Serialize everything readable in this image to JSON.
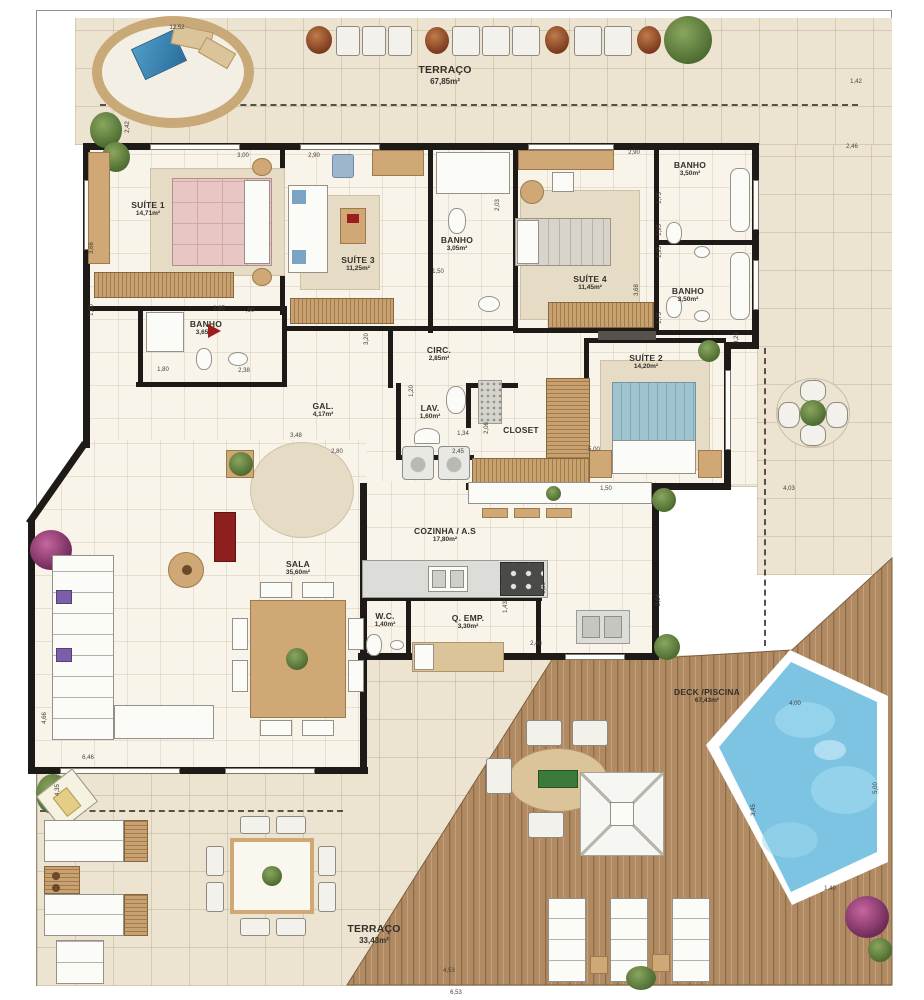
{
  "plan_title": "Penthouse floor plan",
  "colors": {
    "wall": "#1e1a17",
    "tile": "#ece4d1",
    "floor": "#f8f4ea",
    "wood_deck": "#b08a63",
    "pool_water": "#7cc4e2",
    "accent_red": "#9b1c1c",
    "plant_green": "#5f7d3c"
  },
  "rooms": [
    {
      "id": "terraco-top",
      "name": "TERRAÇO",
      "area": "67,85m²"
    },
    {
      "id": "suite-1",
      "name": "SUÍTE 1",
      "area": "14,71m²"
    },
    {
      "id": "suite-3",
      "name": "SUÍTE 3",
      "area": "11,25m²"
    },
    {
      "id": "banho-suite-3",
      "name": "BANHO",
      "area": "3,05m²"
    },
    {
      "id": "suite-4",
      "name": "SUÍTE 4",
      "area": "11,45m²"
    },
    {
      "id": "banho-top-right",
      "name": "BANHO",
      "area": "3,50m²"
    },
    {
      "id": "banho-right-2",
      "name": "BANHO",
      "area": "3,50m²"
    },
    {
      "id": "banho-suite-1",
      "name": "BANHO",
      "area": "3,65m²"
    },
    {
      "id": "circ",
      "name": "CIRC.",
      "area": "2,85m²"
    },
    {
      "id": "gal",
      "name": "GAL.",
      "area": "4,17m²"
    },
    {
      "id": "lav",
      "name": "LAV.",
      "area": "1,60m²"
    },
    {
      "id": "closet",
      "name": "CLOSET",
      "area": ""
    },
    {
      "id": "suite-2",
      "name": "SUÍTE 2",
      "area": "14,20m²"
    },
    {
      "id": "cozinha",
      "name": "COZINHA / A.S",
      "area": "17,80m²"
    },
    {
      "id": "sala",
      "name": "SALA",
      "area": "35,60m²"
    },
    {
      "id": "wc",
      "name": "W.C.",
      "area": "1,40m²"
    },
    {
      "id": "q-emp",
      "name": "Q. EMP.",
      "area": "3,30m²"
    },
    {
      "id": "deck-piscina",
      "name": "DECK /PISCINA",
      "area": "67,43m²"
    },
    {
      "id": "terraco-bottom",
      "name": "TERRAÇO",
      "area": "33,43m²"
    }
  ],
  "dims": [
    "12,52",
    "1,42",
    "2,42",
    "3,00",
    "2,90",
    "2,90",
    "2,46",
    "3,66",
    "1,00",
    "2,03",
    "1,50",
    "1,75",
    "1,95",
    "1,95",
    "1,75",
    "3,68",
    "2,85",
    ",90",
    "3,20",
    "1,80",
    "2,38",
    "3,20",
    "1,20",
    "1,34",
    "2,06",
    "2,45",
    "3,48",
    "2,80",
    "5,00",
    "1,50",
    "4,03",
    "1,43",
    "2,48",
    "2,64",
    "1,36",
    "4,66",
    "6,46",
    "4,35",
    "4,00",
    "5,00",
    "3,45",
    "1,40",
    "4,53",
    "6,53"
  ]
}
